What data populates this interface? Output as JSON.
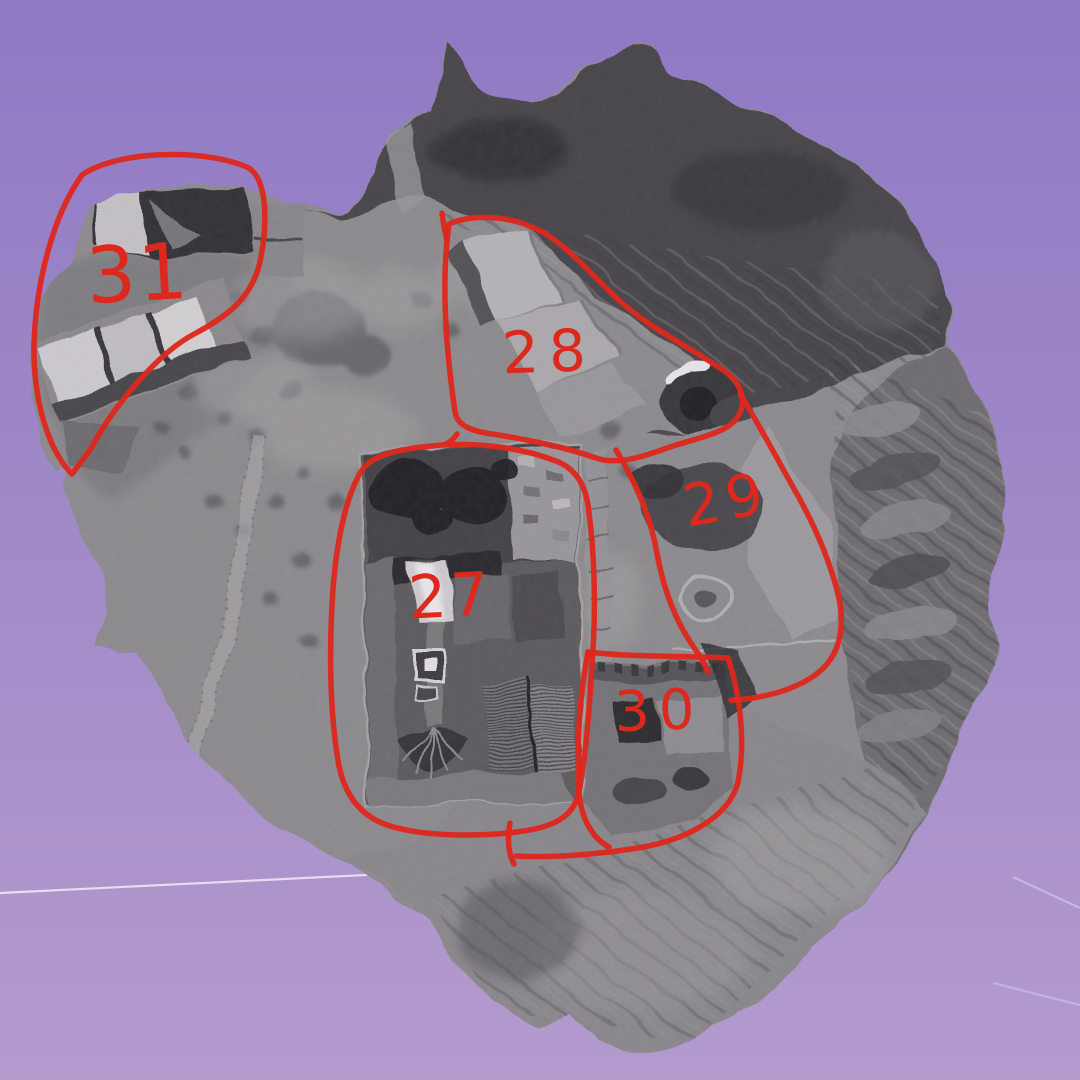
{
  "viewport": {
    "background_top": "#8f79c4",
    "background_mid": "#a18ac8",
    "background_bottom": "#b49bce",
    "annotation_color": "#de281d",
    "ground_line_color": "#e6ddf2"
  },
  "annotations": {
    "area27": {
      "label": "27"
    },
    "area28": {
      "label": "28"
    },
    "area29": {
      "label": "29"
    },
    "area30": {
      "label": "30"
    },
    "area31": {
      "label": "31"
    }
  }
}
